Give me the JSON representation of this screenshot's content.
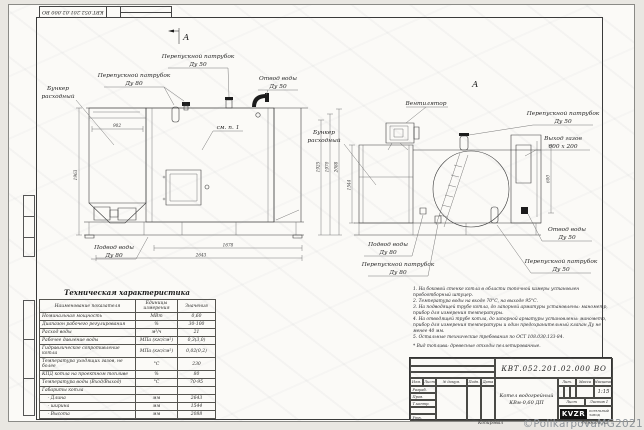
{
  "sheet": {
    "top_stamp_number": "КВТ.052.201.02.000 ВО",
    "watermark": "©PolikarpovaMG2021"
  },
  "drawing": {
    "section_marker": "А",
    "view_label": "А",
    "labels": {
      "bunker1_l1": "Бункер",
      "bunker1_l2": "расходный",
      "bypass80_l1": "Перепускной патрубок",
      "bypass80_l2": "Ду 80",
      "bypass50_l1": "Перепускной патрубок",
      "bypass50_l2": "Ду 50",
      "otvod1_l1": "Отвод воды",
      "otvod1_l2": "Ду 50",
      "see_note": "см. п. 1",
      "podvod1_l1": "Подвод воды",
      "podvod1_l2": "Ду 80",
      "fan": "Вентилятор",
      "bunker2_l1": "Бункер",
      "bunker2_l2": "расходный",
      "bypass50r_l1": "Перепускной патрубок",
      "bypass50r_l2": "Ду 50",
      "gas_l1": "Выход газов",
      "gas_l2": "600 х 200",
      "otvod2_l1": "Отвод воды",
      "otvod2_l2": "Ду 50",
      "bypass50b_l1": "Перепускной патрубок",
      "bypass50b_l2": "Ду 50",
      "podvod2_l1": "Подвод воды",
      "podvod2_l2": "Ду 80",
      "bypass80b_l1": "Перепускной патрубок",
      "bypass80b_l2": "Ду 80"
    },
    "dims": {
      "hopper_width": "902",
      "left_height": "1963",
      "h1": "1925",
      "h2": "1970",
      "h3": "2088",
      "conveyor_len": "1678",
      "total_len": "2643",
      "side_width": "1544",
      "gas_height": "600"
    }
  },
  "tech_table": {
    "title": "Техническая характеристика",
    "headers": [
      "Наименование показателя",
      "Единицы измерения",
      "Значения"
    ],
    "rows": [
      [
        "Номинальная мощность",
        "МВт",
        "0,60"
      ],
      [
        "Диапазон рабочего регулирования",
        "%",
        "30-100"
      ],
      [
        "Расход воды",
        "м³/ч",
        "21"
      ],
      [
        "Рабочее давление воды",
        "МПа (кгс/см²)",
        "0,3(3,0)"
      ],
      [
        "Гидравлическое сопротивление котла",
        "МПа (кгс/см²)",
        "0,02(0,2)"
      ],
      [
        "Температура уходящих газов, не более",
        "°С",
        "230"
      ],
      [
        "КПД котла на проектном топливе",
        "%",
        "80"
      ],
      [
        "Температура воды (Вход/Выход)",
        "°С",
        "70-95"
      ],
      [
        "Габариты котла",
        "",
        ""
      ],
      [
        "    - Длина",
        "мм",
        "2643"
      ],
      [
        "    - ширина",
        "мм",
        "1544"
      ],
      [
        "    - Высота",
        "мм",
        "2088"
      ]
    ]
  },
  "notes": {
    "items": [
      "1. На боковой стенке котла в области топочной камеры установлен пробоотборный штуцер.",
      "2. Температура воды на входе 70°С, на выходе 95°С.",
      "3. На подводящей трубе котла, до запорной арматуры установлены: манометр, прибор для измерения температуры.",
      "4. На отводящей трубе котла, до запорной арматуры установлены: манометр, прибор для измерения температуры и один предохранительный клапан Ду не менее 40 мм.",
      "5. Остальные технические требования по ОСТ 108.030.133-84."
    ],
    "fuel": "* Вид топлива:  древесные отходы пеллетированные."
  },
  "title_block": {
    "doc_number": "КВТ.052.201.02.000  ВО",
    "product_l1": "Котел водогрейный",
    "product_l2": "КВм-0,60  ДП",
    "scale_value": "1:15",
    "col_izm": "Изм.",
    "col_list": "Лист",
    "col_doc": "№ докум.",
    "col_podp": "Подп.",
    "col_data": "Дата",
    "row_razrab": "Разраб.",
    "row_prov": "Пров.",
    "row_tkontr": "Т.контр.",
    "row_nkontr": "Н.контр.",
    "row_utv": "Утв.",
    "lit": "Лит.",
    "massa": "Масса",
    "masshtab": "Масштаб",
    "list": "Лист",
    "listov": "Листов 1",
    "logo": "KVZR",
    "logo_sub": "КОТЕЛЬНЫЙ ЗАВОД",
    "kopiroval": "Копировал",
    "format": "Формат А2"
  }
}
